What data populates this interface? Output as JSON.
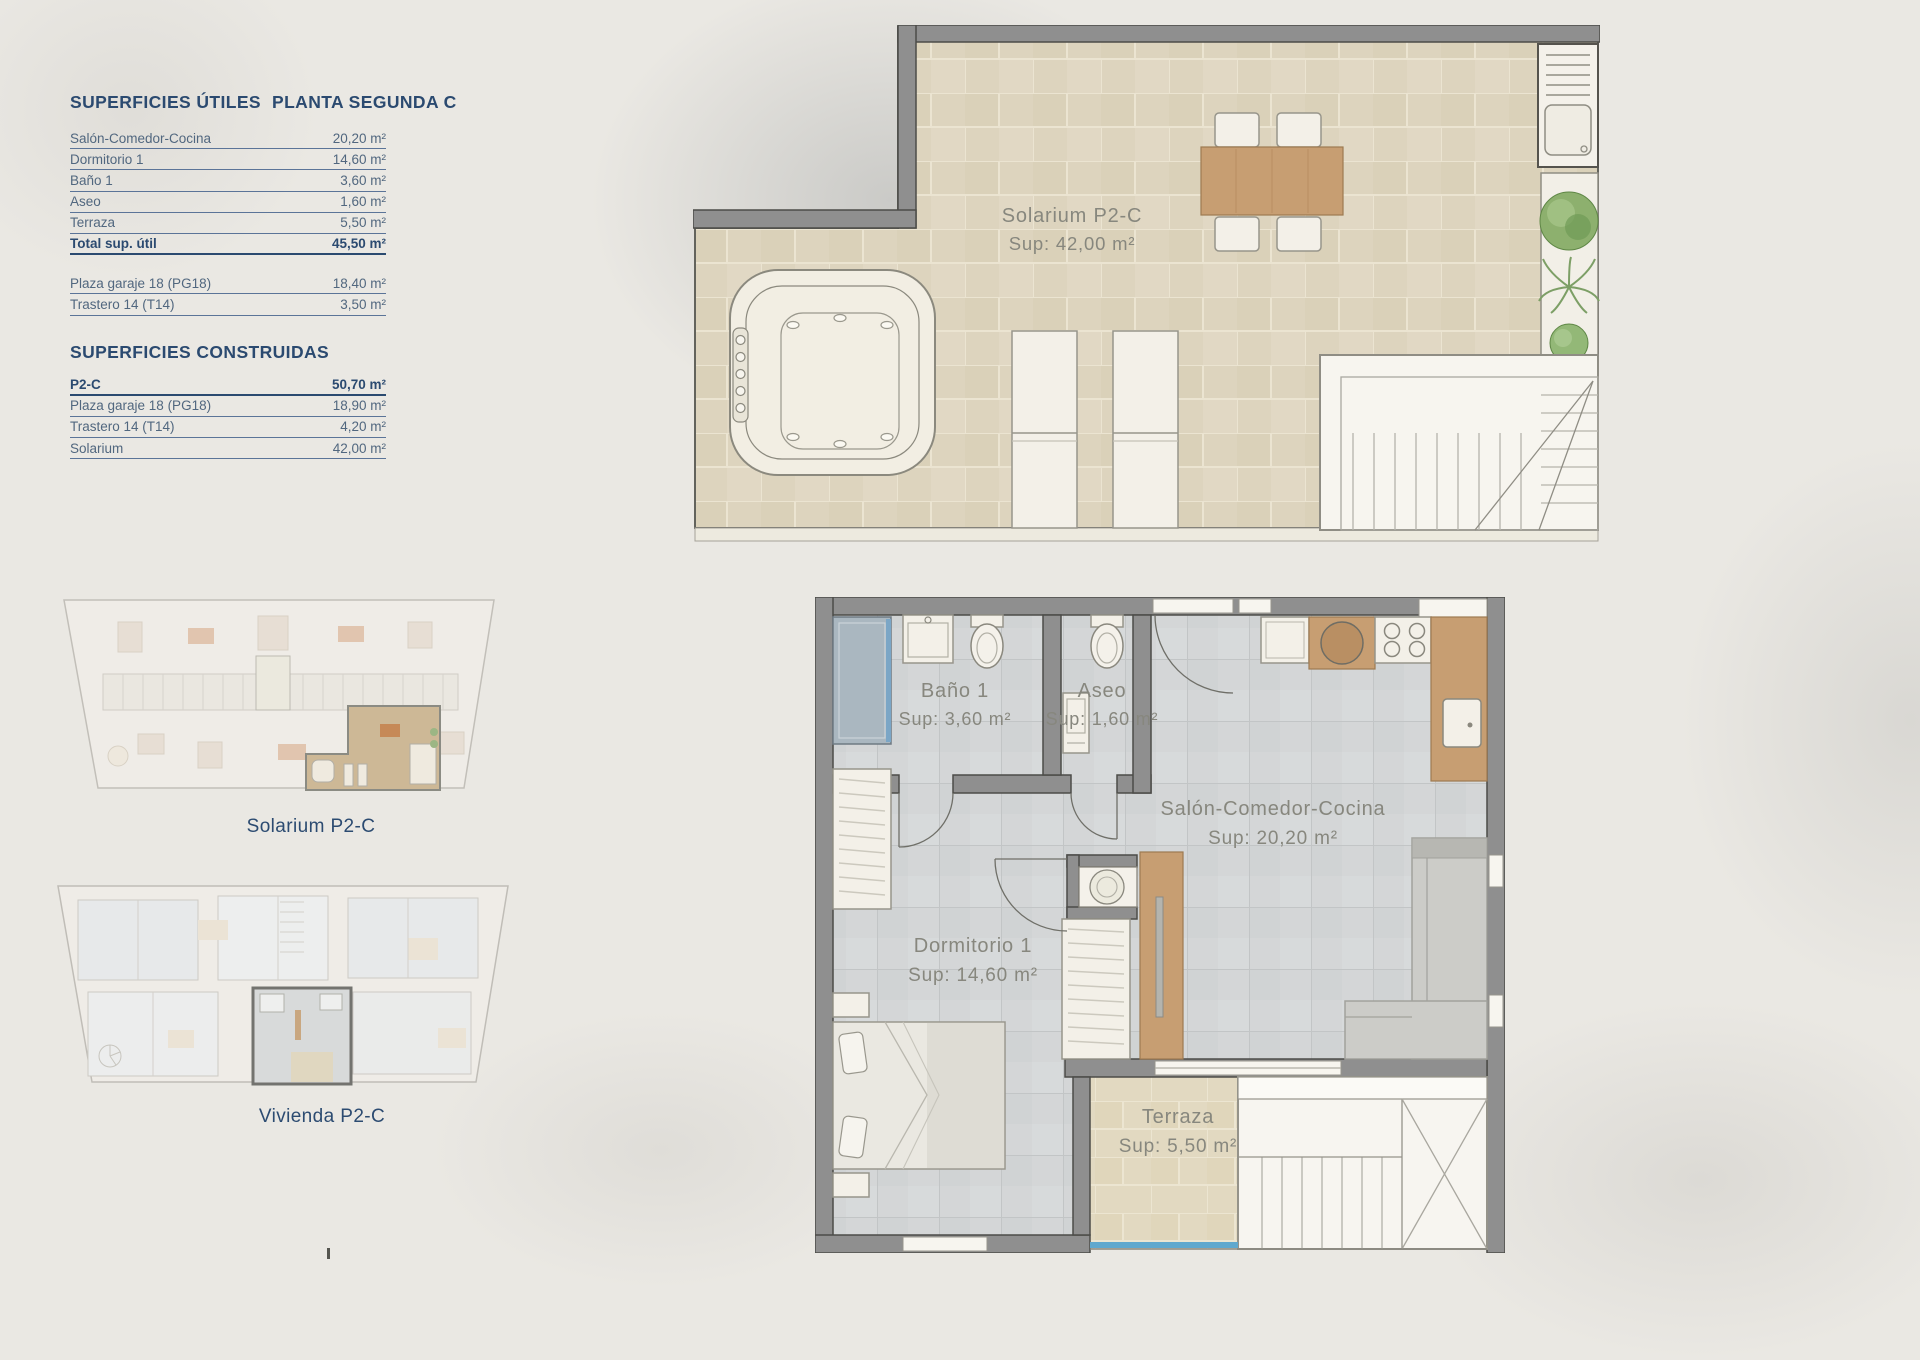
{
  "colors": {
    "accent_blue": "#2b4a70",
    "row_text_blue": "#51677f",
    "plan_label_gray": "#87877e",
    "wall_gray": "#8f8f8f",
    "solarium_tile_beige": "#ddd4be",
    "apartment_tile_gray": "#d4d6d7",
    "terrace_tile_beige": "#e2d9c1",
    "wood": "#c79e72",
    "plant_green": "#8fae74",
    "glass_blue": "#60a8ce"
  },
  "tables": {
    "utiles": {
      "title": "SUPERFICIES ÚTILES",
      "subtitle": "PLANTA SEGUNDA C",
      "rows": [
        {
          "label": "Salón-Comedor-Cocina",
          "value": "20,20 m²"
        },
        {
          "label": "Dormitorio 1",
          "value": "14,60 m²"
        },
        {
          "label": "Baño 1",
          "value": "3,60 m²"
        },
        {
          "label": "Aseo",
          "value": "1,60 m²"
        },
        {
          "label": "Terraza",
          "value": "5,50 m²"
        }
      ],
      "total": {
        "label": "Total sup. útil",
        "value": "45,50 m²"
      },
      "annex_rows": [
        {
          "label": "Plaza garaje 18 (PG18)",
          "value": "18,40 m²"
        },
        {
          "label": "Trastero 14 (T14)",
          "value": "3,50 m²"
        }
      ]
    },
    "construidas": {
      "title": "SUPERFICIES CONSTRUIDAS",
      "rows": [
        {
          "label": "P2-C",
          "value": "50,70 m²"
        },
        {
          "label": "Plaza garaje 18 (PG18)",
          "value": "18,90 m²"
        },
        {
          "label": "Trastero 14 (T14)",
          "value": "4,20 m²"
        },
        {
          "label": "Solarium",
          "value": "42,00 m²"
        }
      ]
    }
  },
  "thumbnails": {
    "solarium": {
      "label": "Solarium P2-C"
    },
    "vivienda": {
      "label": "Vivienda P2-C"
    }
  },
  "solarium_plan": {
    "name": "Solarium P2-C",
    "sup": "Sup: 42,00 m²"
  },
  "apartment_plan": {
    "bano": {
      "name": "Baño 1",
      "sup": "Sup: 3,60 m²"
    },
    "aseo": {
      "name": "Aseo",
      "sup": "Sup: 1,60 m²"
    },
    "salon": {
      "name": "Salón-Comedor-Cocina",
      "sup": "Sup: 20,20 m²"
    },
    "dormitorio": {
      "name": "Dormitorio 1",
      "sup": "Sup: 14,60 m²"
    },
    "terraza": {
      "name": "Terraza",
      "sup": "Sup: 5,50 m²"
    }
  }
}
